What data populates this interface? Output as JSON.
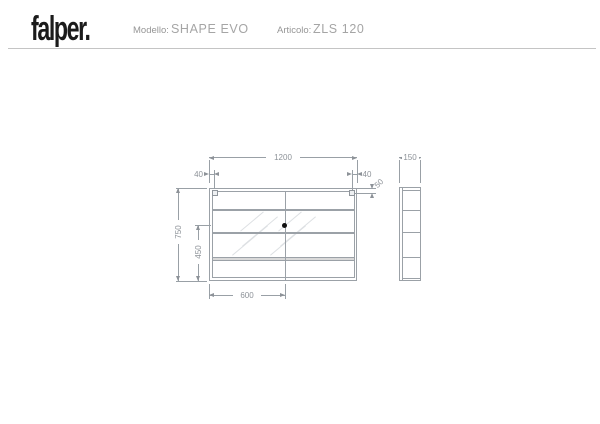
{
  "header": {
    "logo": "falper.",
    "model_label": "Modello:",
    "model_value": "SHAPE EVO",
    "article_label": "Articolo:",
    "article_value": "ZLS 120"
  },
  "drawing": {
    "type": "technical-drawing",
    "views": [
      "front",
      "side"
    ],
    "dims": {
      "width": "1200",
      "height": "750",
      "lower_section": "450",
      "half_width": "600",
      "left_offset": "40",
      "right_offset": "40",
      "bracket_drop": "50",
      "depth": "150"
    }
  },
  "colors": {
    "logo": "#1b1b1b",
    "header_text": "#9b9b9b",
    "outline": "#9ba1a7",
    "dimension": "#8d9298",
    "shelf_band_fill": "#d9d9d9",
    "hatch": "#dde0e3",
    "dot": "#101010",
    "header_rule": "#c4c4c4"
  }
}
